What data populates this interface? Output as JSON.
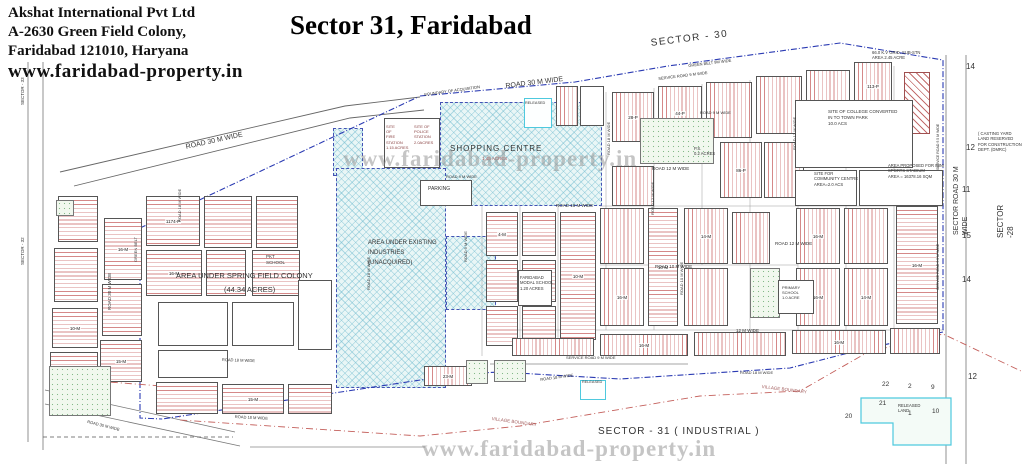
{
  "header": {
    "line1": "Akshat International Pvt Ltd",
    "line2": "A-2630 Green Field Colony,",
    "line3": "Faridabad 121010, Haryana",
    "website": "www.faridabad-property.in"
  },
  "title": "Sector 31, Faridabad",
  "watermark_center": "www.faridabad-property.in",
  "watermark_bottom": "www.faridabad-property.in",
  "map": {
    "hatches": [
      {
        "x": 333,
        "y": 128,
        "w": 30,
        "h": 48
      },
      {
        "x": 440,
        "y": 102,
        "w": 162,
        "h": 104
      },
      {
        "x": 336,
        "y": 168,
        "w": 110,
        "h": 220
      },
      {
        "x": 446,
        "y": 236,
        "w": 50,
        "h": 74
      }
    ],
    "area_labels": [
      {
        "t": "SHOPPING CENTRE",
        "x": 450,
        "y": 144,
        "s": 8,
        "ls": 1
      },
      {
        "t": "1.45 ACRES",
        "x": 482,
        "y": 156,
        "s": 4.5,
        "c": "#b05555"
      },
      {
        "t": "SITE\nOF\nFIRE\nSTATION\n1.15 ACRES",
        "x": 386,
        "y": 124,
        "s": 4,
        "c": "#8a4444"
      },
      {
        "t": "SITE OF\nPOLICE\nSTATION\n2.0ACRES",
        "x": 414,
        "y": 124,
        "s": 4,
        "c": "#8a4444"
      },
      {
        "t": "PARKING",
        "x": 428,
        "y": 186,
        "s": 5
      },
      {
        "t": "AREA UNDER EXISTING\nINDUSTRIES\n(UNACQUIRED)",
        "x": 368,
        "y": 238,
        "s": 6,
        "lh": 1.7
      },
      {
        "t": "AREA UNDER SPRING FIELD COLONY",
        "x": 176,
        "y": 271,
        "s": 7.5
      },
      {
        "t": "(44.34 ACRES)",
        "x": 224,
        "y": 285,
        "s": 7.5
      },
      {
        "t": "PKT\nSCHOOL",
        "x": 266,
        "y": 254,
        "s": 4.5
      },
      {
        "t": "FARIDABAD\nMODAL SCHOOL\n1.20 ACRES",
        "x": 520,
        "y": 275,
        "s": 4.2
      },
      {
        "t": "PRIMARY\nSCHOOL\n1.0 ACRE",
        "x": 782,
        "y": 285,
        "s": 4
      },
      {
        "t": "P.S.\n0.2 ACRES",
        "x": 694,
        "y": 146,
        "s": 4.2
      },
      {
        "t": "SITE OF COLLEGE CONVERTED\nIN TO TOWN PARK\n10.0 ACS",
        "x": 828,
        "y": 109,
        "s": 4.5
      },
      {
        "t": "SITE FOR\nCOMMUNITY CENTRE\nAREA=2.0 ACS",
        "x": 814,
        "y": 171,
        "s": 4.2
      },
      {
        "t": "AREA PROPOSED FOR MINI\nSPORTS STADIUM\nAREA = 16378.16 SQM",
        "x": 888,
        "y": 163,
        "s": 4.2
      },
      {
        "t": "66.0 K.V GRID. SUB-STN\nAREA 2.45 ACRE",
        "x": 872,
        "y": 50,
        "s": 4.2
      },
      {
        "t": "( CASTING YARD\nLAND RESERVED\nFOR CONSTRUCTION\nDEPT. (DMRC)",
        "x": 978,
        "y": 131,
        "s": 4.2
      },
      {
        "t": "RELEASED",
        "x": 525,
        "y": 101,
        "s": 3.8
      },
      {
        "t": "RELEASED",
        "x": 582,
        "y": 380,
        "s": 3.8
      },
      {
        "t": "RELEASED\nLAND",
        "x": 898,
        "y": 403,
        "s": 4.2
      },
      {
        "t": "SECTOR - 31 ( INDUSTRIAL )",
        "x": 598,
        "y": 425,
        "s": 10,
        "ls": 1
      }
    ],
    "road_labels": [
      {
        "t": "SECTOR - 30",
        "x": 650,
        "y": 37,
        "rot": -7,
        "s": 10,
        "ls": 1.5
      },
      {
        "t": "ROAD 30 M WIDE",
        "x": 185,
        "y": 143,
        "rot": -12.5,
        "s": 7
      },
      {
        "t": "ROAD 30 M WIDE",
        "x": 505,
        "y": 82,
        "rot": -7,
        "s": 7
      },
      {
        "t": "BOUNDARY OF ACQUISITION",
        "x": 424,
        "y": 92,
        "rot": -8,
        "s": 4
      },
      {
        "t": "GREEN BELT 9M WIDE",
        "x": 688,
        "y": 63,
        "rot": -7,
        "s": 4
      },
      {
        "t": "SERVICE ROAD 9 M WIDE",
        "x": 658,
        "y": 76,
        "rot": -7,
        "s": 4
      },
      {
        "t": "ROAD 9 M WIDE",
        "x": 446,
        "y": 174,
        "rot": 0,
        "s": 4
      },
      {
        "t": "ROAD 18 M WIDE",
        "x": 556,
        "y": 203,
        "rot": 0,
        "s": 4.5
      },
      {
        "t": "ROAD 12 M WIDE",
        "x": 652,
        "y": 166,
        "rot": 0,
        "s": 4.5
      },
      {
        "t": "ROAD 9 M WIDE",
        "x": 700,
        "y": 110,
        "rot": 0,
        "s": 4
      },
      {
        "t": "ROAD 10 M WIDE",
        "x": 655,
        "y": 264,
        "rot": 0,
        "s": 4.5
      },
      {
        "t": "ROAD 12 M WIDE",
        "x": 775,
        "y": 241,
        "rot": 0,
        "s": 4.5
      },
      {
        "t": "12 M WIDE",
        "x": 736,
        "y": 328,
        "rot": 0,
        "s": 4.5
      },
      {
        "t": "ROAD 30 M WIDE",
        "x": 107,
        "y": 310,
        "rot": -90,
        "s": 4.5
      },
      {
        "t": "GREEN BELT",
        "x": 133,
        "y": 262,
        "rot": -90,
        "s": 4
      },
      {
        "t": "ROAD 18 M WIDE",
        "x": 177,
        "y": 222,
        "rot": -90,
        "s": 4
      },
      {
        "t": "ROAD 18 M WIDE",
        "x": 366,
        "y": 290,
        "rot": -90,
        "s": 4
      },
      {
        "t": "ROAD 18 M WIDE",
        "x": 606,
        "y": 155,
        "rot": -90,
        "s": 4
      },
      {
        "t": "ROAD 12 M WIDE",
        "x": 650,
        "y": 215,
        "rot": -90,
        "s": 4
      },
      {
        "t": "ROAD 12 M WIDE",
        "x": 792,
        "y": 150,
        "rot": -90,
        "s": 4
      },
      {
        "t": "ROAD 10 M WIDE",
        "x": 679,
        "y": 295,
        "rot": -90,
        "s": 4
      },
      {
        "t": "ROAD 9 M WIDE",
        "x": 463,
        "y": 262,
        "rot": -90,
        "s": 4
      },
      {
        "t": "SERVICE ROAD 9.5 M WIDE",
        "x": 936,
        "y": 170,
        "rot": -90,
        "s": 3.5
      },
      {
        "t": "SERVICE ROAD 9.5 M WIDE",
        "x": 936,
        "y": 290,
        "rot": -90,
        "s": 3.5
      },
      {
        "t": "ROAD 18 M WIDE",
        "x": 222,
        "y": 357,
        "rot": 2,
        "s": 4
      },
      {
        "t": "ROAD 18 M WIDE",
        "x": 235,
        "y": 414,
        "rot": 3,
        "s": 4
      },
      {
        "t": "ROAD 30 M WIDE",
        "x": 88,
        "y": 419,
        "rot": 14,
        "s": 4
      },
      {
        "t": "SERVICE ROAD 9 M WIDE",
        "x": 566,
        "y": 355,
        "rot": 0,
        "s": 4
      },
      {
        "t": "ROAD 18 M WIDE",
        "x": 540,
        "y": 377,
        "rot": -8,
        "s": 4
      },
      {
        "t": "ROAD 18 M WIDE",
        "x": 740,
        "y": 370,
        "rot": 0,
        "s": 4
      },
      {
        "t": "VILLAGE BOUNDARY",
        "x": 492,
        "y": 416,
        "rot": 8,
        "s": 4.5,
        "c": "#a05a5a"
      },
      {
        "t": "VILLAGE BOUNDARY",
        "x": 762,
        "y": 384,
        "rot": 7,
        "s": 4.5,
        "c": "#a05a5a"
      },
      {
        "t": "SECTOR ROAD 30 M WIDE",
        "x": 952,
        "y": 235,
        "rot": -90,
        "s": 7
      },
      {
        "t": "SECTOR -28",
        "x": 996,
        "y": 238,
        "rot": -90,
        "s": 8
      },
      {
        "t": "SECTOR - 33",
        "x": 20,
        "y": 105,
        "rot": -90,
        "s": 4.5
      },
      {
        "t": "SECTOR - 32",
        "x": 20,
        "y": 265,
        "rot": -90,
        "s": 4.5
      }
    ],
    "margin_numbers": [
      {
        "t": "14",
        "x": 966,
        "y": 62
      },
      {
        "t": "12",
        "x": 966,
        "y": 143
      },
      {
        "t": "11",
        "x": 962,
        "y": 185
      },
      {
        "t": "15",
        "x": 962,
        "y": 231
      },
      {
        "t": "14",
        "x": 962,
        "y": 275
      },
      {
        "t": "12",
        "x": 968,
        "y": 372
      }
    ],
    "released_numbers": [
      {
        "t": "22",
        "x": 882,
        "y": 381
      },
      {
        "t": "2",
        "x": 908,
        "y": 383
      },
      {
        "t": "9",
        "x": 931,
        "y": 384
      },
      {
        "t": "21",
        "x": 879,
        "y": 400
      },
      {
        "t": "1",
        "x": 908,
        "y": 410
      },
      {
        "t": "10",
        "x": 932,
        "y": 408
      },
      {
        "t": "20",
        "x": 845,
        "y": 413
      }
    ],
    "blocks": [
      {
        "x": 58,
        "y": 196,
        "w": 40,
        "h": 46,
        "f": "h",
        "l": ""
      },
      {
        "x": 54,
        "y": 248,
        "w": 44,
        "h": 54,
        "f": "h",
        "l": ""
      },
      {
        "x": 52,
        "y": 308,
        "w": 46,
        "h": 40,
        "f": "h",
        "l": "10-M"
      },
      {
        "x": 50,
        "y": 352,
        "w": 48,
        "h": 40,
        "f": "h",
        "l": ""
      },
      {
        "x": 104,
        "y": 218,
        "w": 38,
        "h": 62,
        "f": "h",
        "l": "16-M"
      },
      {
        "x": 102,
        "y": 284,
        "w": 40,
        "h": 52,
        "f": "h",
        "l": ""
      },
      {
        "x": 100,
        "y": 340,
        "w": 42,
        "h": 42,
        "f": "h",
        "l": "15-M"
      },
      {
        "x": 146,
        "y": 196,
        "w": 54,
        "h": 50,
        "f": "h",
        "l": "1174-P"
      },
      {
        "x": 204,
        "y": 196,
        "w": 48,
        "h": 52,
        "f": "h",
        "l": ""
      },
      {
        "x": 146,
        "y": 250,
        "w": 56,
        "h": 46,
        "f": "h",
        "l": "16-M"
      },
      {
        "x": 206,
        "y": 250,
        "w": 40,
        "h": 46,
        "f": "h",
        "l": ""
      },
      {
        "x": 256,
        "y": 196,
        "w": 42,
        "h": 52,
        "f": "h",
        "l": ""
      },
      {
        "x": 252,
        "y": 250,
        "w": 48,
        "h": 46,
        "f": "h",
        "l": ""
      },
      {
        "x": 158,
        "y": 302,
        "w": 70,
        "h": 44,
        "f": "p",
        "l": ""
      },
      {
        "x": 232,
        "y": 302,
        "w": 62,
        "h": 44,
        "f": "p",
        "l": ""
      },
      {
        "x": 298,
        "y": 280,
        "w": 34,
        "h": 70,
        "f": "p",
        "l": ""
      },
      {
        "x": 158,
        "y": 350,
        "w": 70,
        "h": 28,
        "f": "p",
        "l": ""
      },
      {
        "x": 156,
        "y": 382,
        "w": 62,
        "h": 32,
        "f": "h",
        "l": ""
      },
      {
        "x": 222,
        "y": 384,
        "w": 62,
        "h": 30,
        "f": "h",
        "l": "15-M"
      },
      {
        "x": 288,
        "y": 384,
        "w": 44,
        "h": 30,
        "f": "h",
        "l": ""
      },
      {
        "x": 486,
        "y": 212,
        "w": 32,
        "h": 44,
        "f": "h",
        "l": "4-M"
      },
      {
        "x": 486,
        "y": 260,
        "w": 32,
        "h": 42,
        "f": "h",
        "l": ""
      },
      {
        "x": 486,
        "y": 306,
        "w": 32,
        "h": 40,
        "f": "h",
        "l": ""
      },
      {
        "x": 522,
        "y": 212,
        "w": 34,
        "h": 44,
        "f": "h",
        "l": ""
      },
      {
        "x": 522,
        "y": 260,
        "w": 34,
        "h": 42,
        "f": "h",
        "l": ""
      },
      {
        "x": 522,
        "y": 306,
        "w": 34,
        "h": 40,
        "f": "h",
        "l": ""
      },
      {
        "x": 560,
        "y": 212,
        "w": 36,
        "h": 128,
        "f": "h",
        "l": "10-M"
      },
      {
        "x": 424,
        "y": 366,
        "w": 48,
        "h": 20,
        "f": "v",
        "l": "23-M"
      },
      {
        "x": 612,
        "y": 92,
        "w": 42,
        "h": 50,
        "f": "v",
        "l": "28-P"
      },
      {
        "x": 658,
        "y": 86,
        "w": 44,
        "h": 54,
        "f": "v",
        "l": "44-P"
      },
      {
        "x": 706,
        "y": 82,
        "w": 46,
        "h": 56,
        "f": "v",
        "l": ""
      },
      {
        "x": 756,
        "y": 76,
        "w": 46,
        "h": 58,
        "f": "v",
        "l": ""
      },
      {
        "x": 806,
        "y": 70,
        "w": 44,
        "h": 52,
        "f": "v",
        "l": ""
      },
      {
        "x": 854,
        "y": 62,
        "w": 38,
        "h": 48,
        "f": "v",
        "l": "113-P"
      },
      {
        "x": 612,
        "y": 166,
        "w": 42,
        "h": 40,
        "f": "v",
        "l": ""
      },
      {
        "x": 720,
        "y": 142,
        "w": 42,
        "h": 56,
        "f": "v",
        "l": "86-P"
      },
      {
        "x": 764,
        "y": 142,
        "w": 40,
        "h": 56,
        "f": "v",
        "l": ""
      },
      {
        "x": 600,
        "y": 208,
        "w": 44,
        "h": 56,
        "f": "v",
        "l": ""
      },
      {
        "x": 648,
        "y": 208,
        "w": 30,
        "h": 118,
        "f": "h",
        "l": "10-M"
      },
      {
        "x": 684,
        "y": 208,
        "w": 44,
        "h": 56,
        "f": "v",
        "l": "14-M"
      },
      {
        "x": 684,
        "y": 268,
        "w": 44,
        "h": 58,
        "f": "v",
        "l": ""
      },
      {
        "x": 732,
        "y": 212,
        "w": 38,
        "h": 52,
        "f": "v",
        "l": ""
      },
      {
        "x": 600,
        "y": 268,
        "w": 44,
        "h": 58,
        "f": "v",
        "l": "16-M"
      },
      {
        "x": 796,
        "y": 208,
        "w": 44,
        "h": 56,
        "f": "v",
        "l": "16-M"
      },
      {
        "x": 796,
        "y": 268,
        "w": 44,
        "h": 58,
        "f": "v",
        "l": "16-M"
      },
      {
        "x": 844,
        "y": 208,
        "w": 44,
        "h": 56,
        "f": "v",
        "l": ""
      },
      {
        "x": 844,
        "y": 268,
        "w": 44,
        "h": 58,
        "f": "v",
        "l": "14-M"
      },
      {
        "x": 896,
        "y": 206,
        "w": 42,
        "h": 118,
        "f": "h",
        "l": "16-M"
      },
      {
        "x": 600,
        "y": 334,
        "w": 88,
        "h": 22,
        "f": "v",
        "l": "16-M"
      },
      {
        "x": 694,
        "y": 332,
        "w": 92,
        "h": 24,
        "f": "v",
        "l": ""
      },
      {
        "x": 792,
        "y": 330,
        "w": 94,
        "h": 24,
        "f": "v",
        "l": "16-M"
      },
      {
        "x": 890,
        "y": 328,
        "w": 50,
        "h": 26,
        "f": "v",
        "l": ""
      },
      {
        "x": 512,
        "y": 338,
        "w": 82,
        "h": 18,
        "f": "v",
        "l": ""
      },
      {
        "x": 640,
        "y": 118,
        "w": 74,
        "h": 46,
        "f": "d",
        "l": ""
      },
      {
        "x": 750,
        "y": 268,
        "w": 30,
        "h": 50,
        "f": "d",
        "l": ""
      },
      {
        "x": 49,
        "y": 366,
        "w": 62,
        "h": 50,
        "f": "d",
        "l": ""
      },
      {
        "x": 56,
        "y": 200,
        "w": 18,
        "h": 16,
        "f": "d",
        "l": ""
      },
      {
        "x": 466,
        "y": 360,
        "w": 22,
        "h": 24,
        "f": "d",
        "l": ""
      },
      {
        "x": 494,
        "y": 360,
        "w": 32,
        "h": 22,
        "f": "d",
        "l": ""
      },
      {
        "x": 904,
        "y": 72,
        "w": 26,
        "h": 62,
        "f": "hr",
        "l": ""
      },
      {
        "x": 384,
        "y": 118,
        "w": 56,
        "h": 50,
        "f": "p",
        "l": ""
      },
      {
        "x": 420,
        "y": 180,
        "w": 52,
        "h": 26,
        "f": "p",
        "l": ""
      },
      {
        "x": 556,
        "y": 86,
        "w": 22,
        "h": 40,
        "f": "v",
        "l": ""
      },
      {
        "x": 580,
        "y": 86,
        "w": 24,
        "h": 40,
        "f": "p",
        "l": ""
      },
      {
        "x": 518,
        "y": 270,
        "w": 34,
        "h": 36,
        "f": "p",
        "l": ""
      },
      {
        "x": 778,
        "y": 280,
        "w": 36,
        "h": 34,
        "f": "p",
        "l": ""
      },
      {
        "x": 795,
        "y": 100,
        "w": 118,
        "h": 68,
        "f": "p",
        "l": ""
      },
      {
        "x": 795,
        "y": 170,
        "w": 62,
        "h": 36,
        "f": "p",
        "l": ""
      },
      {
        "x": 859,
        "y": 170,
        "w": 84,
        "h": 36,
        "f": "p",
        "l": ""
      },
      {
        "x": 524,
        "y": 98,
        "w": 28,
        "h": 30,
        "f": "rel",
        "l": ""
      },
      {
        "x": 580,
        "y": 380,
        "w": 26,
        "h": 20,
        "f": "rel",
        "l": ""
      }
    ]
  }
}
